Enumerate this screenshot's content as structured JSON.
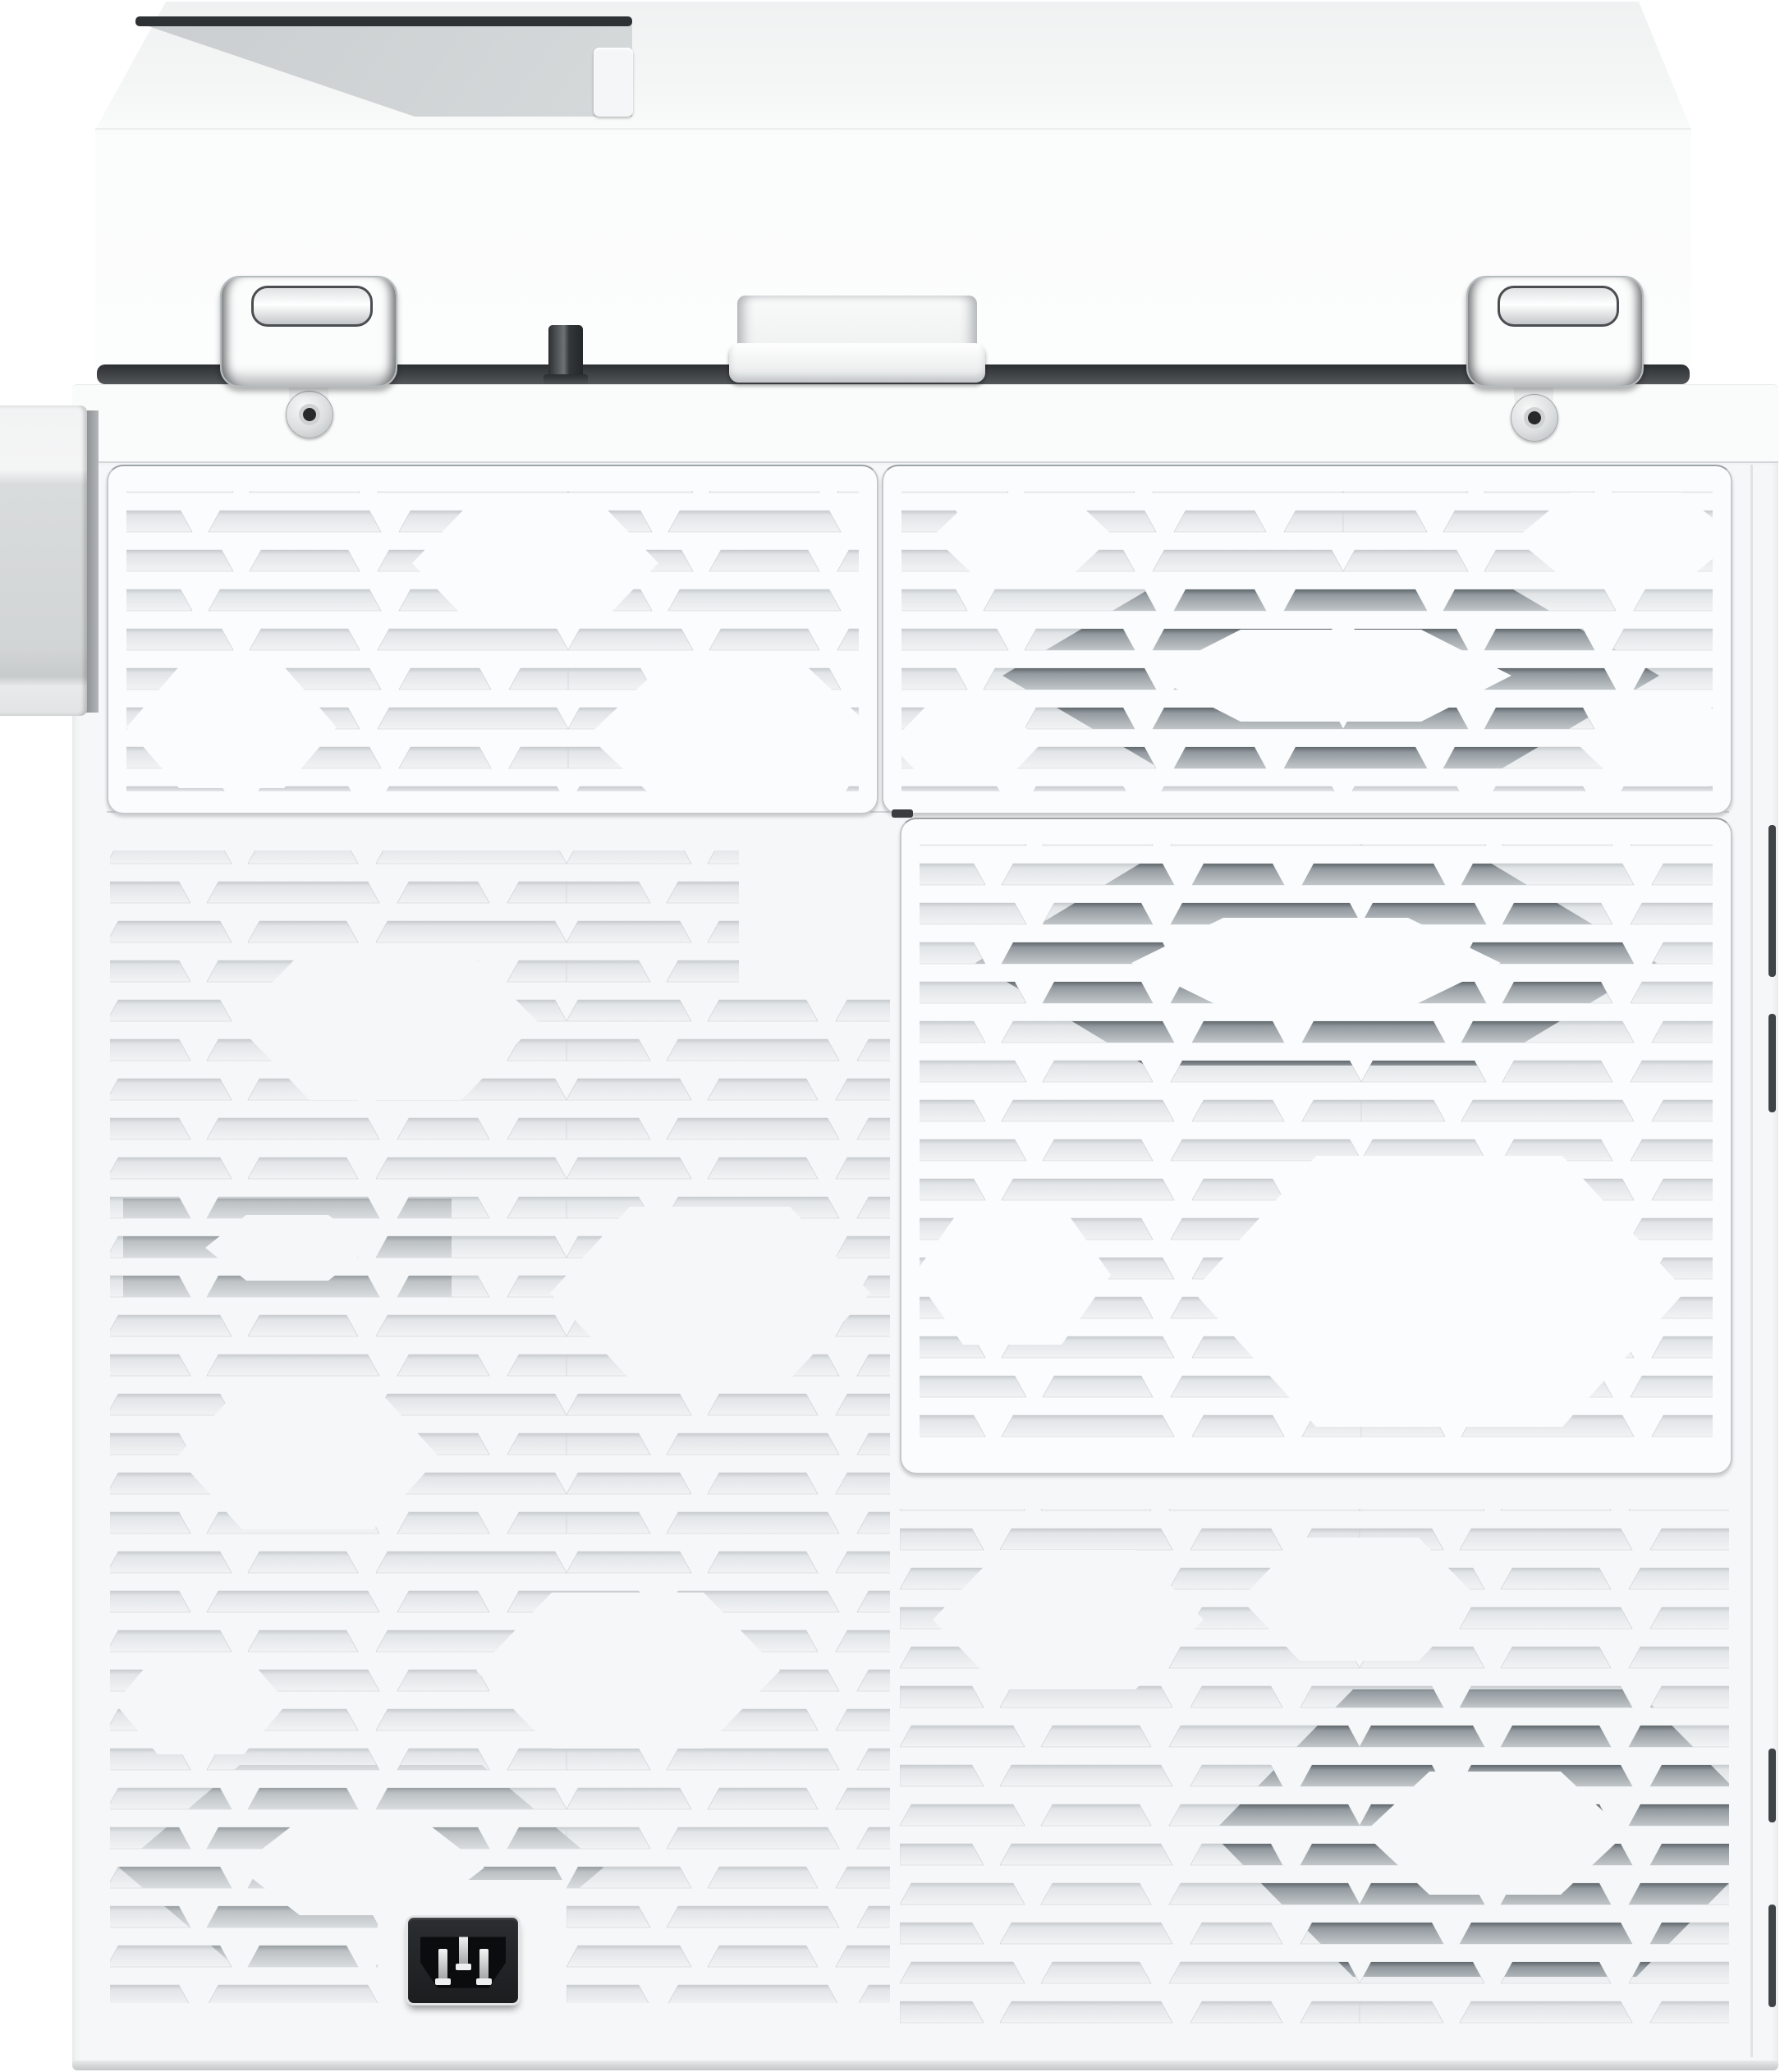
{
  "image": {
    "kind": "product-photo",
    "subject": "Rear view of a white multifunction laser printer with hexagonal vent pattern, two lid hinges and an IEC power inlet",
    "visible_text": "none"
  },
  "colors": {
    "background": "#ffffff",
    "body_white": "#fbfcfd",
    "back_cover": "#f6f7f8",
    "seam": "#d2d5d6",
    "dark_gap": "#303335",
    "vent_slot_light": "#e9ecec",
    "vent_slot_medium": "#bfc4c7",
    "vent_slot_dark": "#9aa1a5",
    "panel_border": "#c5c9cc",
    "power_inlet": "#1d1f21",
    "pin_metal": "#d7d9da"
  }
}
